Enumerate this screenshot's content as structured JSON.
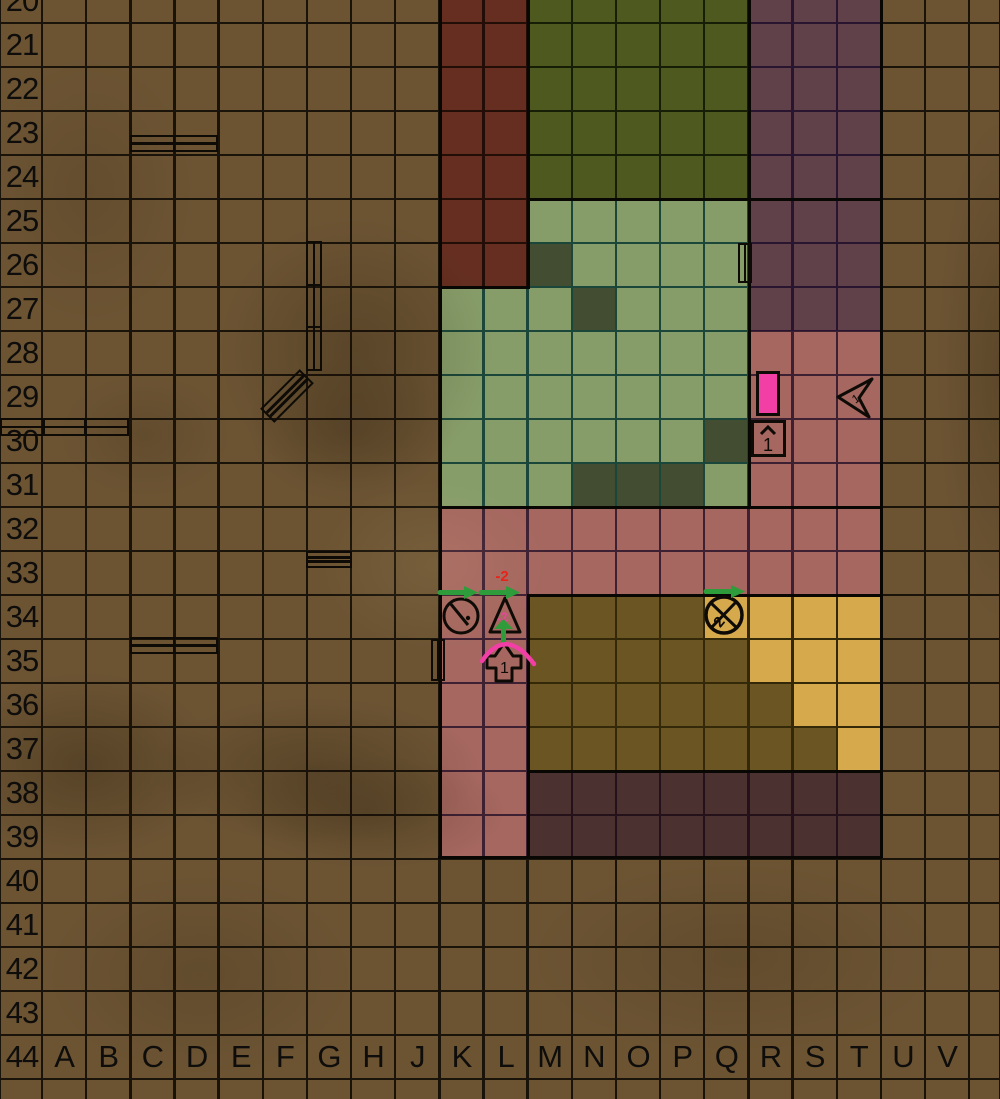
{
  "board": {
    "title": "tactical-grid-map",
    "row_labels": [
      "20",
      "21",
      "22",
      "23",
      "24",
      "25",
      "26",
      "27",
      "28",
      "29",
      "30",
      "31",
      "32",
      "33",
      "34",
      "35",
      "36",
      "37",
      "38",
      "39",
      "40",
      "41",
      "42",
      "43",
      "44"
    ],
    "column_labels": [
      "A",
      "B",
      "C",
      "D",
      "E",
      "F",
      "G",
      "H",
      "J",
      "K",
      "L",
      "M",
      "N",
      "O",
      "P",
      "Q",
      "R",
      "S",
      "T",
      "U",
      "V"
    ],
    "colors": {
      "ground": "#6c5433",
      "ground_line": "#1a1309",
      "dark_red": "#652e20",
      "dark_red_line": "#220e07",
      "dark_green": "#4d591f",
      "dark_green_line": "#161f05",
      "light_green": "#879d69",
      "light_green_line": "#1b473a",
      "rubble_dark": "#424d31",
      "purple": "#604149",
      "purple_line": "#2a1530",
      "pink": "#a5675f",
      "pink_line": "#3e2033",
      "olive": "#6a5523",
      "olive_line": "#332909",
      "yellow": "#d6a94c",
      "dark_purple": "#4b3230",
      "dark_purple_line": "#241119",
      "thick_border": "#090704",
      "marker_stroke": "#0e0b07",
      "bright_pink": "#f23fa6",
      "green_arrow": "#2f9c3b",
      "red_text": "#e92318",
      "magenta_text": "#e8459c",
      "label_text": "#0e0d0b"
    },
    "regions": [
      {
        "name": "building-dark-red",
        "colFrom": "K",
        "colTo": "L",
        "rowFrom": 20,
        "rowTo": 26,
        "fill": "dark_red",
        "line": "dark_red_line"
      },
      {
        "name": "building-dark-green",
        "colFrom": "M",
        "colTo": "Q",
        "rowFrom": 20,
        "rowTo": 24,
        "fill": "dark_green",
        "line": "dark_green_line"
      },
      {
        "name": "courtyard-light-green-upper",
        "colFrom": "M",
        "colTo": "Q",
        "rowFrom": 25,
        "rowTo": 26,
        "fill": "light_green",
        "line": "light_green_line"
      },
      {
        "name": "courtyard-light-green-lower",
        "colFrom": "K",
        "colTo": "Q",
        "rowFrom": 27,
        "rowTo": 31,
        "fill": "light_green",
        "line": "light_green_line"
      },
      {
        "name": "building-purple",
        "colFrom": "R",
        "colTo": "T",
        "rowFrom": 20,
        "rowTo": 27,
        "fill": "purple",
        "line": "purple_line"
      },
      {
        "name": "pink-right-wing",
        "colFrom": "R",
        "colTo": "T",
        "rowFrom": 28,
        "rowTo": 31,
        "fill": "pink",
        "line": "pink_line"
      },
      {
        "name": "pink-band",
        "colFrom": "K",
        "colTo": "T",
        "rowFrom": 32,
        "rowTo": 33,
        "fill": "pink",
        "line": "pink_line"
      },
      {
        "name": "pink-column",
        "colFrom": "K",
        "colTo": "L",
        "rowFrom": 34,
        "rowTo": 39,
        "fill": "pink",
        "line": "pink_line"
      },
      {
        "name": "building-olive",
        "colFrom": "M",
        "colTo": "T",
        "rowFrom": 34,
        "rowTo": 37,
        "fill": "olive",
        "line": "olive_line"
      },
      {
        "name": "building-dark-purple",
        "colFrom": "M",
        "colTo": "T",
        "rowFrom": 38,
        "rowTo": 39,
        "fill": "dark_purple",
        "line": "dark_purple_line"
      }
    ],
    "special_cells": [
      {
        "name": "rubble-cell-m26",
        "col": "M",
        "row": 26,
        "fill": "rubble_dark"
      },
      {
        "name": "rubble-cell-n27",
        "col": "N",
        "row": 27,
        "fill": "rubble_dark"
      },
      {
        "name": "rubble-cell-q30",
        "col": "Q",
        "row": 30,
        "fill": "rubble_dark"
      },
      {
        "name": "rubble-cell-n31",
        "col": "N",
        "row": 31,
        "fill": "rubble_dark"
      },
      {
        "name": "rubble-cell-o31",
        "col": "O",
        "row": 31,
        "fill": "rubble_dark"
      },
      {
        "name": "rubble-cell-p31",
        "col": "P",
        "row": 31,
        "fill": "rubble_dark"
      },
      {
        "name": "yellow-cell-q34",
        "col": "Q",
        "row": 34,
        "fill": "yellow"
      },
      {
        "name": "yellow-cell-r34",
        "col": "R",
        "row": 34,
        "fill": "yellow"
      },
      {
        "name": "yellow-cell-s34",
        "col": "S",
        "row": 34,
        "fill": "yellow"
      },
      {
        "name": "yellow-cell-t34",
        "col": "T",
        "row": 34,
        "fill": "yellow"
      },
      {
        "name": "yellow-cell-r35",
        "col": "R",
        "row": 35,
        "fill": "yellow"
      },
      {
        "name": "yellow-cell-s35",
        "col": "S",
        "row": 35,
        "fill": "yellow"
      },
      {
        "name": "yellow-cell-t35",
        "col": "T",
        "row": 35,
        "fill": "yellow"
      },
      {
        "name": "yellow-cell-s36",
        "col": "S",
        "row": 36,
        "fill": "yellow"
      },
      {
        "name": "yellow-cell-t36",
        "col": "T",
        "row": 36,
        "fill": "yellow"
      },
      {
        "name": "yellow-cell-t37",
        "col": "T",
        "row": 37,
        "fill": "yellow"
      }
    ],
    "border_segments": [
      {
        "name": "wall-west",
        "x": 438.5,
        "y": 0,
        "w": 3,
        "h": 858
      },
      {
        "name": "wall-red-east-upper",
        "x": 526.5,
        "y": 0,
        "w": 3,
        "h": 288
      },
      {
        "name": "wall-olive-west",
        "x": 526.5,
        "y": 594,
        "w": 3,
        "h": 264
      },
      {
        "name": "wall-court-east",
        "x": 747.5,
        "y": 0,
        "w": 3,
        "h": 508
      },
      {
        "name": "wall-east",
        "x": 879.5,
        "y": 0,
        "w": 3,
        "h": 858
      },
      {
        "name": "wall-green-south",
        "x": 527,
        "y": 197.5,
        "w": 354,
        "h": 3
      },
      {
        "name": "wall-red-south",
        "x": 438,
        "y": 285.5,
        "w": 92,
        "h": 3
      },
      {
        "name": "wall-court-south",
        "x": 438,
        "y": 505.5,
        "w": 444,
        "h": 3
      },
      {
        "name": "wall-olive-north",
        "x": 527,
        "y": 593.5,
        "w": 354,
        "h": 3
      },
      {
        "name": "wall-olive-south",
        "x": 527,
        "y": 769.5,
        "w": 354,
        "h": 3
      },
      {
        "name": "wall-south",
        "x": 438,
        "y": 855.5,
        "w": 444,
        "h": 3
      }
    ],
    "markers": [
      {
        "type": "door-h",
        "name": "double-door-c23",
        "x": 130,
        "y": 135,
        "w": 88,
        "h": 17,
        "segments": 2,
        "lines": 1
      },
      {
        "type": "door-h",
        "name": "double-door-a30",
        "x": 0,
        "y": 418,
        "w": 129,
        "h": 18,
        "segments": 3,
        "lines": 1
      },
      {
        "type": "door-h",
        "name": "double-door-c35",
        "x": 130,
        "y": 637,
        "w": 88,
        "h": 17,
        "segments": 2,
        "lines": 1
      },
      {
        "type": "door-h",
        "name": "door-g33",
        "x": 306,
        "y": 551,
        "w": 46,
        "h": 17,
        "segments": 1,
        "lines": 2
      },
      {
        "type": "door-v",
        "name": "door-g26-g28",
        "x": 306,
        "y": 241,
        "w": 16,
        "h": 130,
        "segments": 3,
        "lines": 1
      },
      {
        "type": "door-v",
        "name": "door-q26",
        "x": 738,
        "y": 243,
        "w": 14,
        "h": 40,
        "segments": 1,
        "lines": 1
      },
      {
        "type": "door-v",
        "name": "door-j35",
        "x": 431,
        "y": 639,
        "w": 14,
        "h": 42,
        "segments": 1,
        "lines": 1
      },
      {
        "type": "door-diag",
        "name": "door-f29",
        "cx": 287,
        "cy": 396,
        "w": 56,
        "h": 20,
        "angle": -45,
        "lines": 2
      },
      {
        "type": "pink-bar",
        "name": "pink-bar-r29",
        "x": 756,
        "y": 371,
        "w": 24,
        "h": 45
      },
      {
        "type": "up-box",
        "name": "up-1-marker-r30",
        "x": 751,
        "y": 420,
        "w": 35,
        "h": 37,
        "label": "1"
      },
      {
        "type": "dart",
        "name": "dart-1-marker-t29",
        "x": 836,
        "y": 377,
        "w": 42,
        "h": 44,
        "label": "1"
      },
      {
        "type": "circle-slash",
        "name": "clock-marker-k34",
        "cx": 461,
        "cy": 616,
        "r": 17
      },
      {
        "type": "circle-x",
        "name": "crossed-2-marker-q34",
        "cx": 724,
        "cy": 615,
        "r": 18,
        "label": "2"
      },
      {
        "type": "triangle",
        "name": "triangle-marker-l34",
        "x": 488,
        "y": 596,
        "w": 32,
        "h": 37,
        "label": "-2"
      },
      {
        "type": "cross",
        "name": "cross-1-marker-l35",
        "x": 486,
        "y": 641,
        "w": 34,
        "h": 40,
        "label": "1"
      },
      {
        "type": "label",
        "name": "red-minus-2-label",
        "x": 502,
        "y": 578,
        "text": "-2",
        "size": 15
      },
      {
        "type": "arrow-h",
        "name": "green-arrow-k34",
        "x": 438,
        "y": 586,
        "w": 40
      },
      {
        "type": "arrow-h",
        "name": "green-arrow-l34",
        "x": 479,
        "y": 586,
        "w": 41
      },
      {
        "type": "arrow-h",
        "name": "green-arrow-q33",
        "x": 704,
        "y": 585,
        "w": 41
      },
      {
        "type": "arrow-up",
        "name": "green-arrow-l35",
        "x": 494,
        "y": 619,
        "w": 19,
        "h": 25
      },
      {
        "type": "arc",
        "name": "pink-arc-l35",
        "x": 478,
        "y": 624,
        "w": 62,
        "h": 44
      }
    ]
  }
}
